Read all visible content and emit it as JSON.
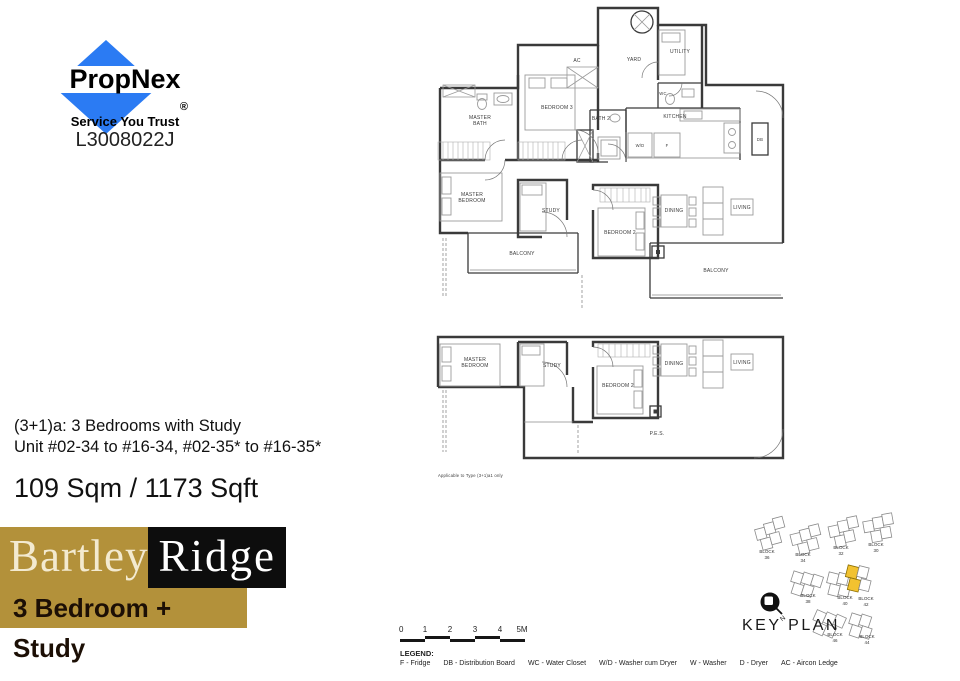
{
  "propnex": {
    "name": "PropNex",
    "registered": "®",
    "tagline": "Service You Trust",
    "license": "L3008022J",
    "blue": "#2b7bf3"
  },
  "unit_info": {
    "type_line": "(3+1)a: 3 Bedrooms with Study",
    "unit_line": "Unit  #02-34 to #16-34, #02-35* to #16-35*",
    "area_line": "109 Sqm / 1173 Sqft"
  },
  "project": {
    "name_left": "Bartley",
    "name_right": "Ridge",
    "subtitle": "3 Bedroom + Study",
    "gold": "#b3913a"
  },
  "plan_upper": {
    "rooms": {
      "master_bath": [
        "MASTER",
        "BATH"
      ],
      "bedroom3": "BEDROOM 3",
      "ac": "AC",
      "yard": "YARD",
      "utility": "UTILITY",
      "wc": "WC",
      "kitchen": "KITCHEN",
      "bath2": "BATH 2",
      "wd": "W/D",
      "f": "F",
      "db": "DB",
      "master_bedroom": [
        "MASTER",
        "BEDROOM"
      ],
      "study": "STUDY",
      "bedroom2": "BEDROOM 2",
      "dining": "DINING",
      "living": "LIVING",
      "balcony_left": "BALCONY",
      "balcony_right": "BALCONY"
    }
  },
  "plan_lower": {
    "rooms": {
      "master_bedroom": [
        "MASTER",
        "BEDROOM"
      ],
      "study": "STUDY",
      "bedroom2": "BEDROOM 2",
      "dining": "DINING",
      "living": "LIVING",
      "pes": "P.E.S."
    },
    "caption": "Applicable to Type (3+1)a1 only"
  },
  "key_plan": {
    "title": "KEY PLAN",
    "north_label": "N",
    "highlight_color": "#f2c230",
    "blocks": [
      {
        "label": "BLOCK",
        "num": "36"
      },
      {
        "label": "BLOCK",
        "num": "34"
      },
      {
        "label": "BLOCK",
        "num": "32"
      },
      {
        "label": "BLOCK",
        "num": "30"
      },
      {
        "label": "BLOCK",
        "num": "38"
      },
      {
        "label": "BLOCK",
        "num": "40"
      },
      {
        "label": "BLOCK",
        "num": "42"
      },
      {
        "label": "BLOCK",
        "num": "46"
      },
      {
        "label": "BLOCK",
        "num": "44"
      }
    ]
  },
  "scale_bar": {
    "ticks": [
      "0",
      "1",
      "2",
      "3",
      "4",
      "5M"
    ]
  },
  "legend": {
    "heading": "LEGEND:",
    "items": [
      "F - Fridge",
      "DB - Distribution Board",
      "WC - Water Closet",
      "W/D - Washer cum Dryer",
      "W - Washer",
      "D - Dryer",
      "AC - Aircon Ledge"
    ]
  }
}
